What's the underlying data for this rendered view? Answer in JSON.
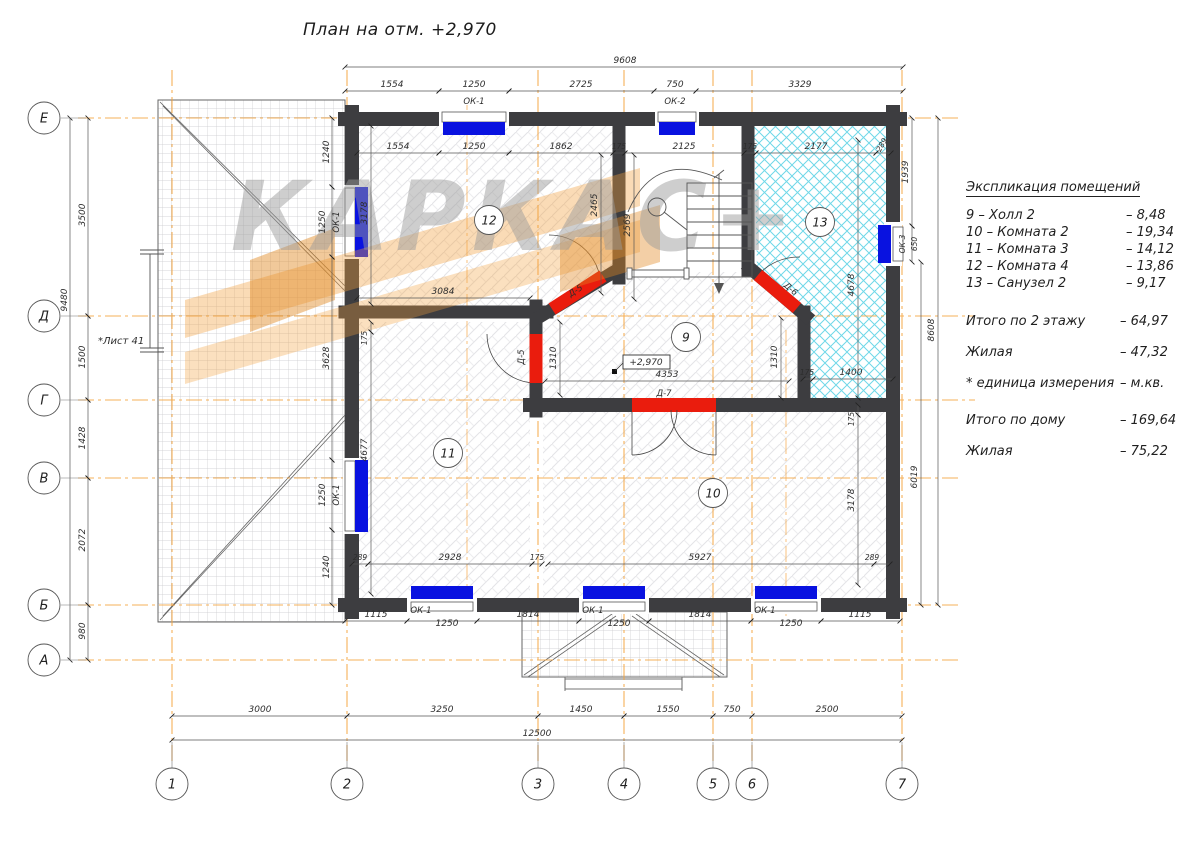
{
  "title": "План на отм. +2,970",
  "watermark_text": "КАРКАС+",
  "note_sheet": "*Лист 41",
  "level_mark": "+2,970",
  "axes": {
    "rows": [
      "Е",
      "Д",
      "Г",
      "В",
      "Б",
      "А"
    ],
    "cols": [
      "1",
      "2",
      "3",
      "4",
      "5",
      "6",
      "7"
    ]
  },
  "room_numbers": {
    "r9": "9",
    "r10": "10",
    "r11": "11",
    "r12": "12",
    "r13": "13"
  },
  "window_labels": {
    "ok1": "ОК-1",
    "ok2": "ОК-2",
    "ok3": "ОК-3"
  },
  "door_labels": {
    "d5": "Д-5",
    "d6": "Д-6",
    "d7": "Д-7"
  },
  "dims": {
    "top_overall": "9608",
    "top": [
      "1554",
      "1250",
      "2725",
      "750",
      "3329"
    ],
    "inner_top": [
      "1554",
      "1250",
      "1862",
      "175",
      "2125",
      "175",
      "2177",
      "289"
    ],
    "left_overall": "9480",
    "left": [
      "3500",
      "1500",
      "1428",
      "2072",
      "980"
    ],
    "left_wall": [
      "1240",
      "1250",
      "3628",
      "1250",
      "1240"
    ],
    "right_top": "1939",
    "right_ok3": "650",
    "right_overall": "8608",
    "right_lower": "6019",
    "r13_in": [
      "4678",
      "175",
      "1400"
    ],
    "r12_in": [
      "3178",
      "3084",
      "2465",
      "2569"
    ],
    "r11_in": [
      "175",
      "4677",
      "289",
      "2928",
      "175"
    ],
    "r10_in": [
      "175",
      "3178",
      "5927",
      "289"
    ],
    "r9_in": [
      "1310",
      "4353",
      "1310"
    ],
    "bottom_wall": [
      "1115",
      "1250",
      "1814",
      "1250",
      "1814",
      "1250",
      "1115"
    ],
    "bottom_axes": [
      "3000",
      "3250",
      "1450",
      "1550",
      "750",
      "2500"
    ],
    "bottom_overall": "12500"
  },
  "legend": {
    "title": "Экспликация помещений",
    "items": [
      {
        "name": "9 – Холл 2",
        "value": "– 8,48"
      },
      {
        "name": "10 – Комната 2",
        "value": "– 19,34"
      },
      {
        "name": "11 – Комната 3",
        "value": "– 14,12"
      },
      {
        "name": "12 – Комната 4",
        "value": "– 13,86"
      },
      {
        "name": "13 – Санузел 2",
        "value": "– 9,17"
      }
    ],
    "totals": [
      {
        "name": "Итого по 2 этажу",
        "value": "– 64,97"
      },
      {
        "name": "Жилая",
        "value": "– 47,32"
      },
      {
        "name": "* единица измерения",
        "value": "– м.кв."
      },
      {
        "name": "Итого по дому",
        "value": "– 169,64"
      },
      {
        "name": "Жилая",
        "value": "– 75,22"
      }
    ]
  }
}
